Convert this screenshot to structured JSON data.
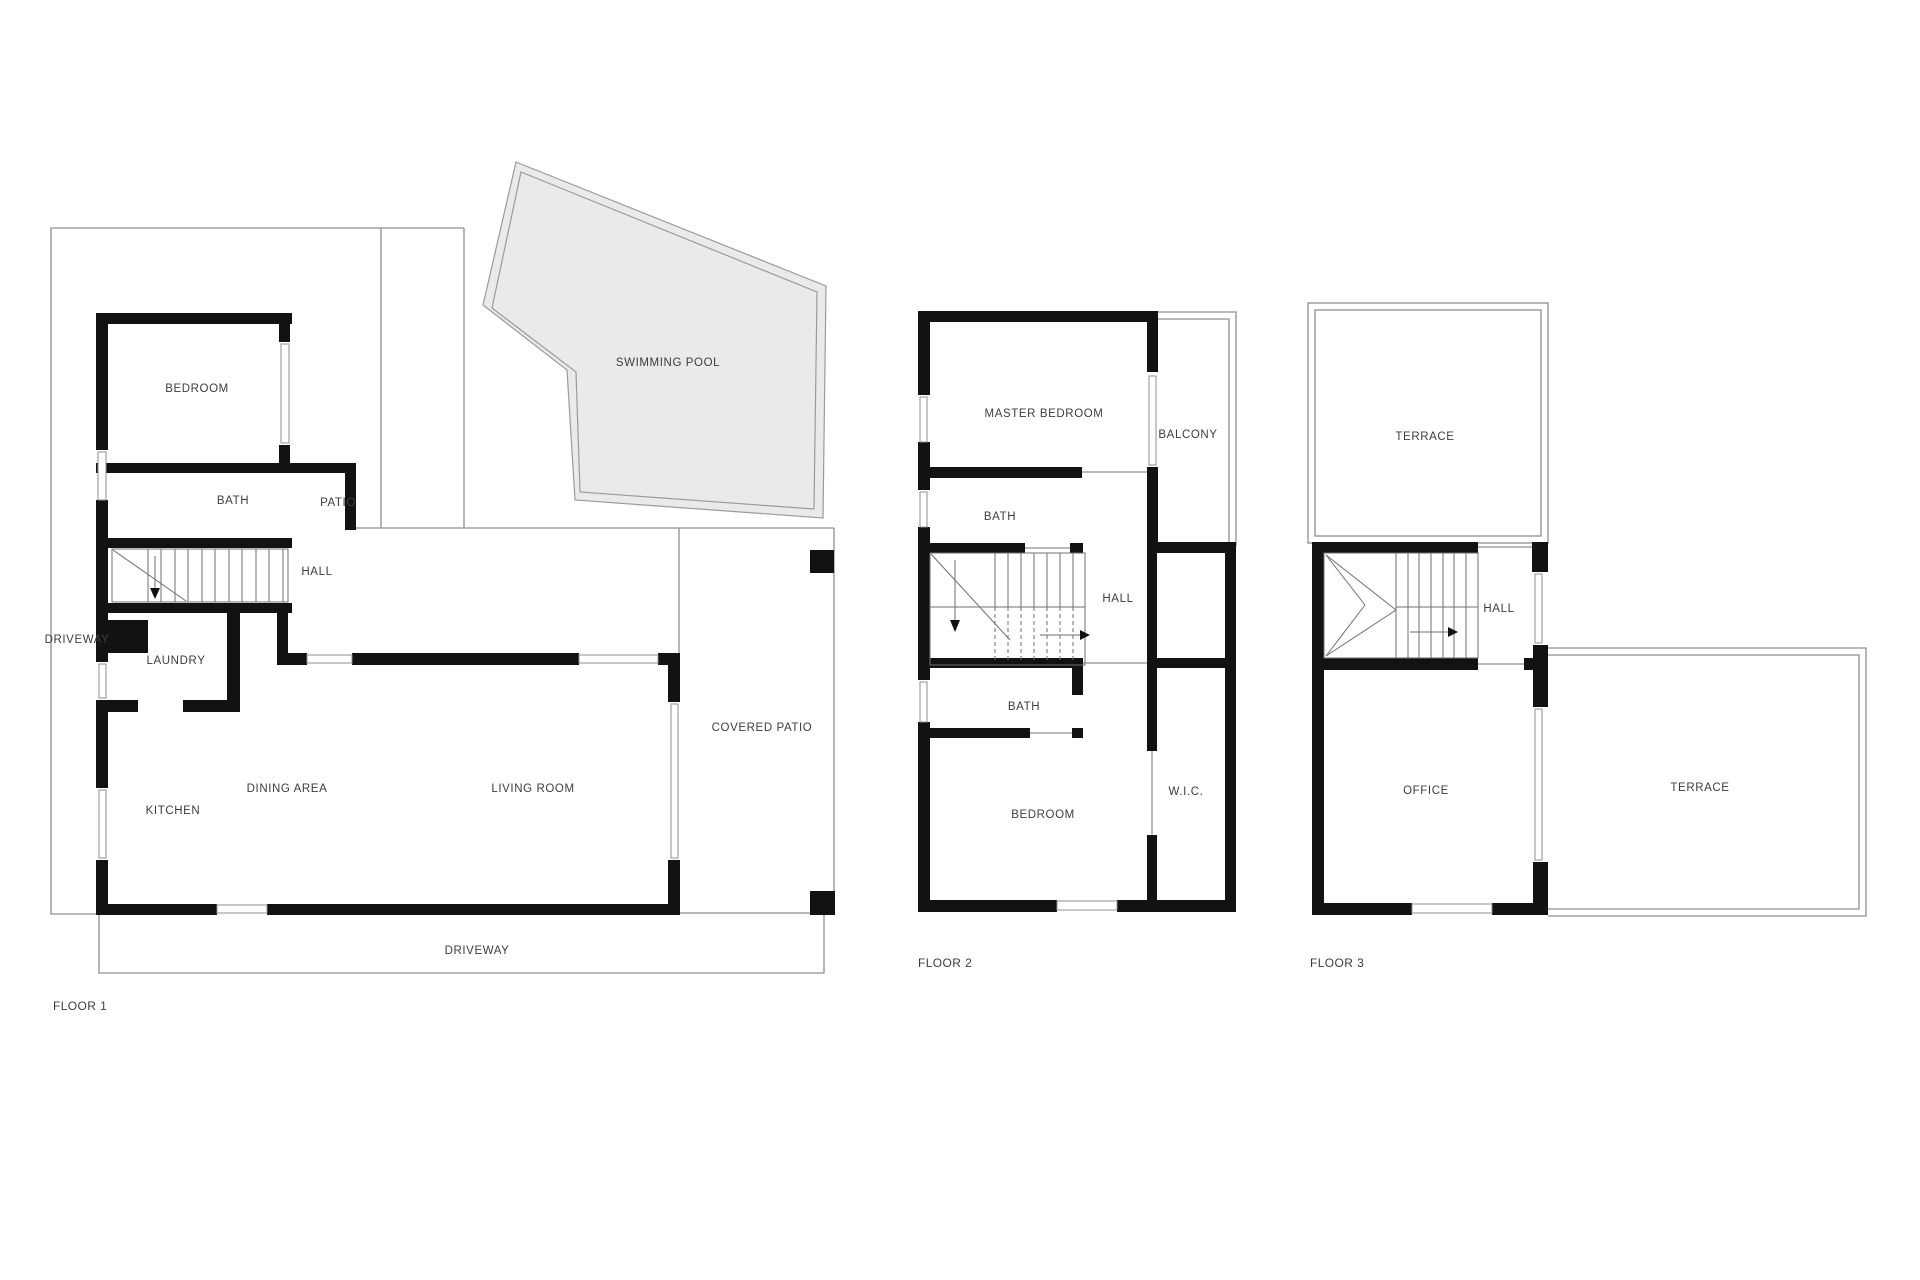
{
  "colors": {
    "bg": "#ffffff",
    "wall": "#121212",
    "line": "#8f8f8f",
    "stair": "#6f6f6f",
    "poolfill": "#e9eaea",
    "poolstroke": "#9b9b9b",
    "text": "#3d3d3d"
  },
  "floor1": {
    "label": "FLOOR 1",
    "rooms": {
      "bedroom": "BEDROOM",
      "bath": "BATH",
      "hall": "HALL",
      "patio": "PATIO",
      "pool": "SWIMMING POOL",
      "driveway_side": "DRIVEWAY",
      "laundry": "LAUNDRY",
      "kitchen": "KITCHEN",
      "dining": "DINING AREA",
      "living": "LIVING ROOM",
      "covered_patio": "COVERED PATIO",
      "driveway_bottom": "DRIVEWAY"
    }
  },
  "floor2": {
    "label": "FLOOR 2",
    "rooms": {
      "master": "MASTER BEDROOM",
      "balcony": "BALCONY",
      "bath_upper": "BATH",
      "hall": "HALL",
      "bath_lower": "BATH",
      "bedroom": "BEDROOM",
      "wic": "W.I.C."
    }
  },
  "floor3": {
    "label": "FLOOR 3",
    "rooms": {
      "terrace_top": "TERRACE",
      "hall": "HALL",
      "office": "OFFICE",
      "terrace_right": "TERRACE"
    }
  }
}
